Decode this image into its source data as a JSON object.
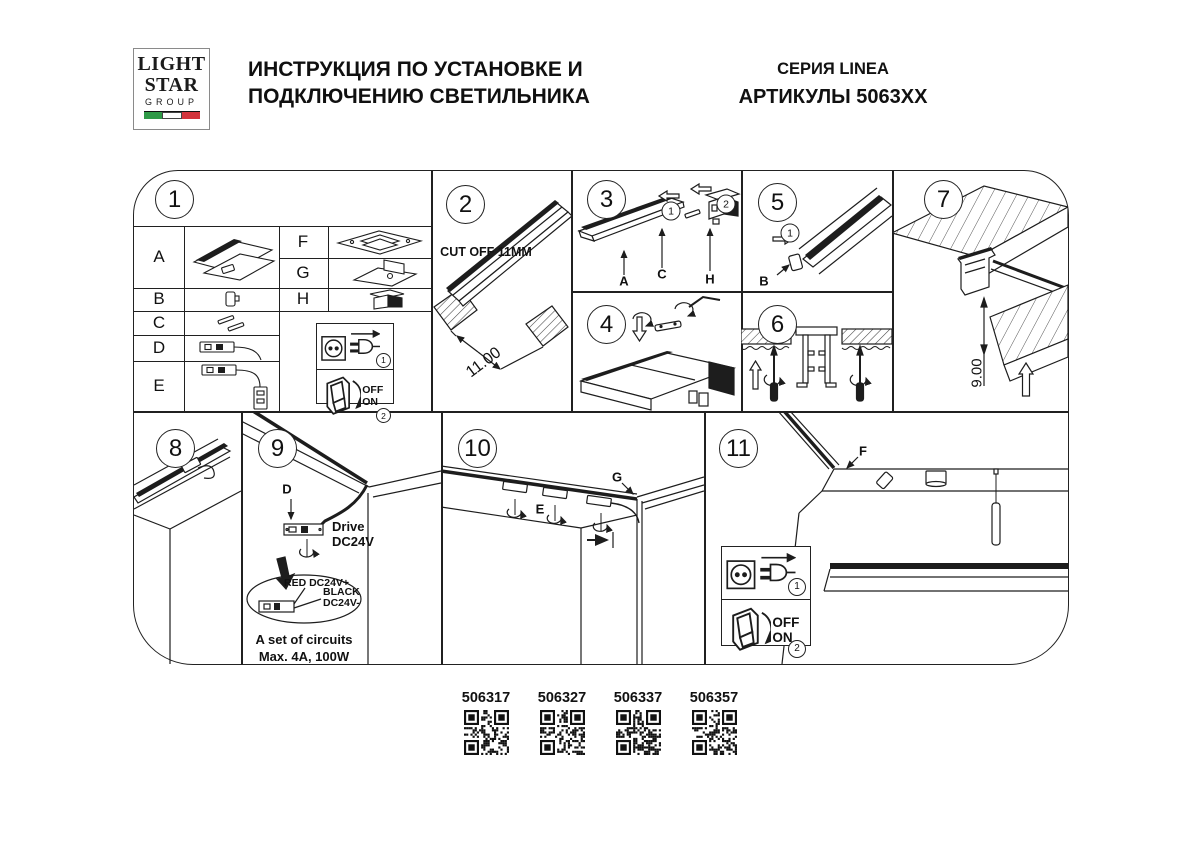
{
  "header": {
    "logo": {
      "line1": "LIGHT",
      "line2": "STAR",
      "line3": "GROUP"
    },
    "title_line1": "ИНСТРУКЦИЯ ПО УСТАНОВКЕ И",
    "title_line2": "ПОДКЛЮЧЕНИЮ СВЕТИЛЬНИКА",
    "series": "СЕРИЯ LINEA",
    "articles": "АРТИКУЛЫ 5063XX"
  },
  "colors": {
    "line": "#1d1d1d",
    "flag_green": "#2f9a47",
    "flag_red": "#d2333c"
  },
  "panels": {
    "p1": {
      "number": "1",
      "parts": [
        "A",
        "B",
        "C",
        "D",
        "E",
        "F",
        "G",
        "H"
      ]
    },
    "p2": {
      "number": "2",
      "note": "CUT OFF 11MM",
      "dimension": "11.00"
    },
    "p3": {
      "number": "3",
      "step1": "1",
      "step2": "2",
      "label_a": "A",
      "label_c": "C",
      "label_h": "H"
    },
    "p4": {
      "number": "4"
    },
    "p5": {
      "number": "5",
      "step1": "1",
      "label_b": "B"
    },
    "p6": {
      "number": "6"
    },
    "p7": {
      "number": "7",
      "dimension": "9.00"
    },
    "p8": {
      "number": "8"
    },
    "p9": {
      "number": "9",
      "label_d": "D",
      "drive_line1": "Drive",
      "drive_line2": "DC24V",
      "wire_red": "RED DC24V+",
      "wire_black_line1": "BLACK",
      "wire_black_line2": "DC24V-",
      "circuits_line1": "A set of circuits",
      "circuits_line2": "Max. 4A, 100W"
    },
    "p10": {
      "number": "10",
      "label_e": "E",
      "label_g": "G"
    },
    "p11": {
      "number": "11",
      "label_f": "F"
    }
  },
  "power_box": {
    "step1": "1",
    "step2": "2",
    "off": "OFF",
    "on": "ON"
  },
  "qr": {
    "items": [
      {
        "code": "506317"
      },
      {
        "code": "506327"
      },
      {
        "code": "506337"
      },
      {
        "code": "506357"
      }
    ]
  }
}
